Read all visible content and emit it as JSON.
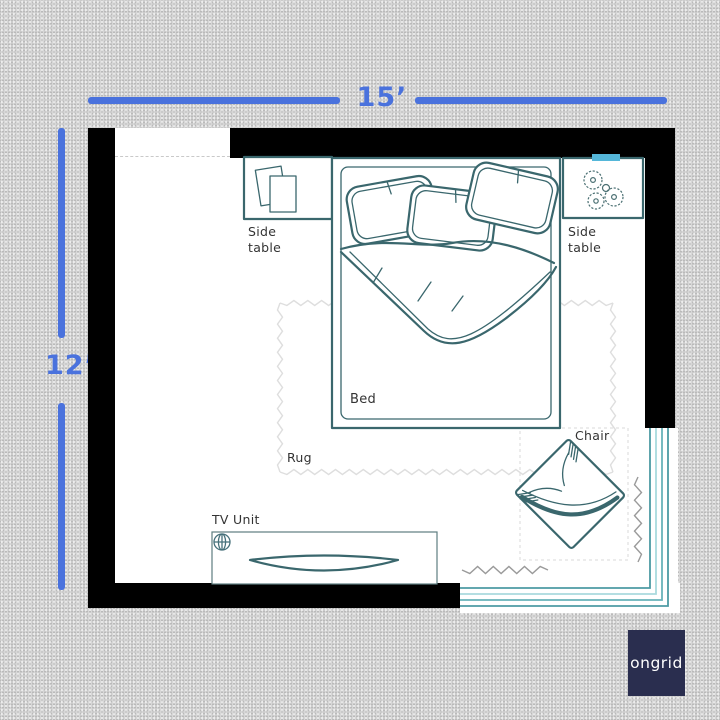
{
  "dimensions": {
    "horizontal": "15’",
    "vertical": "12’"
  },
  "room": {
    "labels": {
      "side_table_left": "Side\ntable",
      "side_table_right": "Side\ntable",
      "bed": "Bed",
      "rug": "Rug",
      "chair": "Chair",
      "tv_unit": "TV Unit"
    }
  },
  "logo": {
    "text": "ongrid"
  },
  "icons": {
    "books": "books-icon",
    "plant": "plant-icon",
    "crosshair": "crosshair-icon",
    "tv": "tv-icon",
    "window_marker": "window-marker",
    "curtain": "curtain-squiggle-icon"
  },
  "colors": {
    "dimension-blue": "#4a72dd",
    "furniture-teal": "#3a676d",
    "window-cyan": "#55b7d9",
    "glass-teal": "#4d9ba4",
    "glass-teal-light": "#a9dade",
    "wall-black": "#000000",
    "floor-white": "#ffffff",
    "bg-gray": "#d7d7d7",
    "label-gray": "#333333",
    "rug-gray": "#dedede",
    "squiggle-gray": "#9a9a9a",
    "logo-navy": "#2a2e4f"
  }
}
